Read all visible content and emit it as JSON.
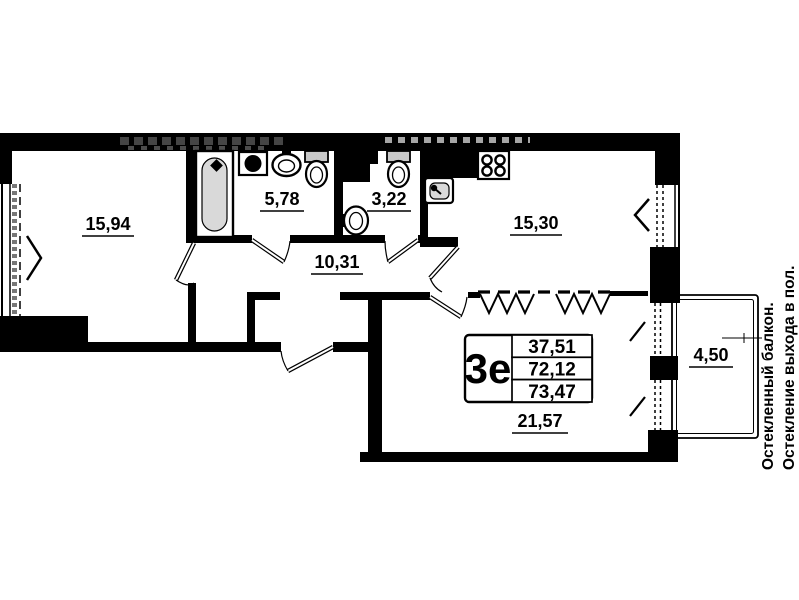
{
  "stamp": {
    "type_label": "3е",
    "living_area": "37,51",
    "floor_area": "72,12",
    "total_area": "73,47"
  },
  "rooms": {
    "bedroom": "15,94",
    "bathroom": "5,78",
    "wc": "3,22",
    "kitchen": "15,30",
    "hallway": "10,31",
    "living": "21,57",
    "balcony": "4,50"
  },
  "annotations": {
    "note1": "Остекленный балкон.",
    "note2": "Остекление выхода в пол."
  },
  "icons": {
    "bathtub": "bathtub-icon",
    "washing_machine": "washing-machine-icon",
    "washbasin": "washbasin-icon",
    "toilet_bathroom": "toilet-icon",
    "toilet_wc": "toilet-icon",
    "bidet": "bidet-icon",
    "stove": "stove-icon",
    "kitchen_sink": "kitchen-sink-icon",
    "window_open_left": "chevron-right-icon",
    "window_open_kitchen": "chevron-left-icon"
  },
  "colors": {
    "wall": "#000000",
    "fixture_fill": "#d9d9d9",
    "background": "#ffffff"
  }
}
